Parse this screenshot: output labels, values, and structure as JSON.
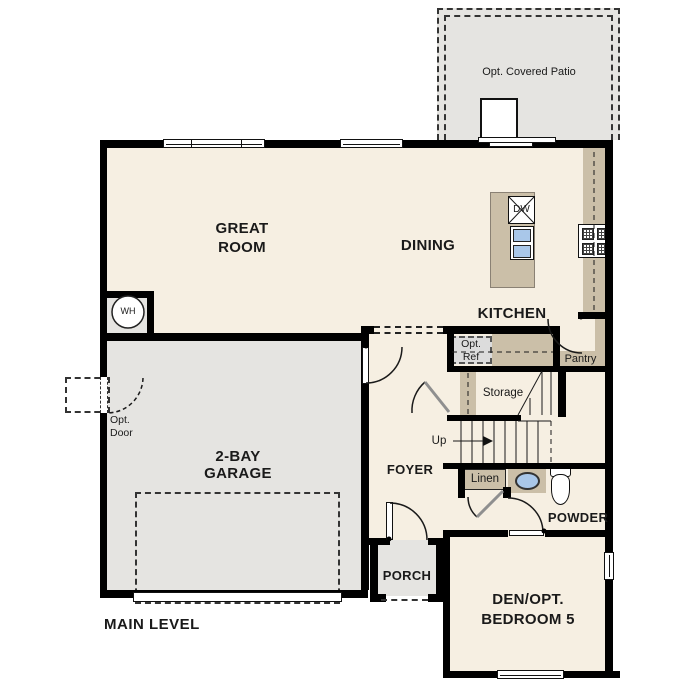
{
  "plan": {
    "level_label": "MAIN LEVEL",
    "rooms": {
      "great_room": "GREAT\nROOM",
      "dining": "DINING",
      "kitchen": "KITCHEN",
      "garage": "2-BAY\nGARAGE",
      "foyer": "FOYER",
      "porch": "PORCH",
      "powder": "POWDER",
      "den": "DEN/OPT.\nBEDROOM 5",
      "patio": "Opt. Covered Patio"
    },
    "features": {
      "dw": "DW",
      "wh": "WH",
      "opt_ref": "Opt.\nRef",
      "pantry": "Pantry",
      "storage": "Storage",
      "up": "Up",
      "linen": "Linen",
      "opt_door": "Opt.\nDoor"
    },
    "colors": {
      "floor": "#f6efe2",
      "hard": "#e5e4e1",
      "counter": "#cbbfa8",
      "wall": "#000000",
      "sink": "#a9c7e9",
      "optref": "#dcdcdc",
      "text": "#1a1a1a"
    }
  }
}
